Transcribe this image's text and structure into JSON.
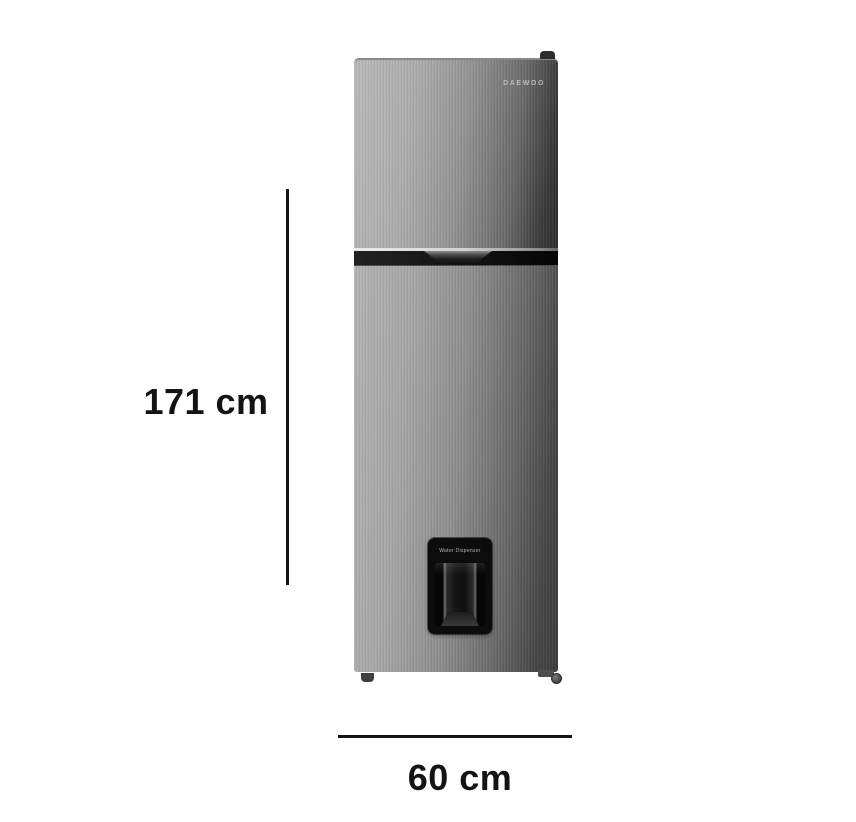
{
  "image": {
    "type": "product-dimension-diagram",
    "subject": "top-freezer refrigerator with water dispenser",
    "background_color": "#ffffff"
  },
  "product": {
    "brand": "DAEWOO",
    "dispenser_label": "Water Dispenser"
  },
  "annotations": {
    "height": "171 cm",
    "width": "60 cm"
  },
  "colors": {
    "annotation_ink": "#141414",
    "steel_light": "#b9b9b9",
    "steel_mid": "#8e8e8e",
    "steel_dark": "#3a3a3a",
    "band_black": "#131313",
    "dispenser_black": "#0c0c0c"
  }
}
